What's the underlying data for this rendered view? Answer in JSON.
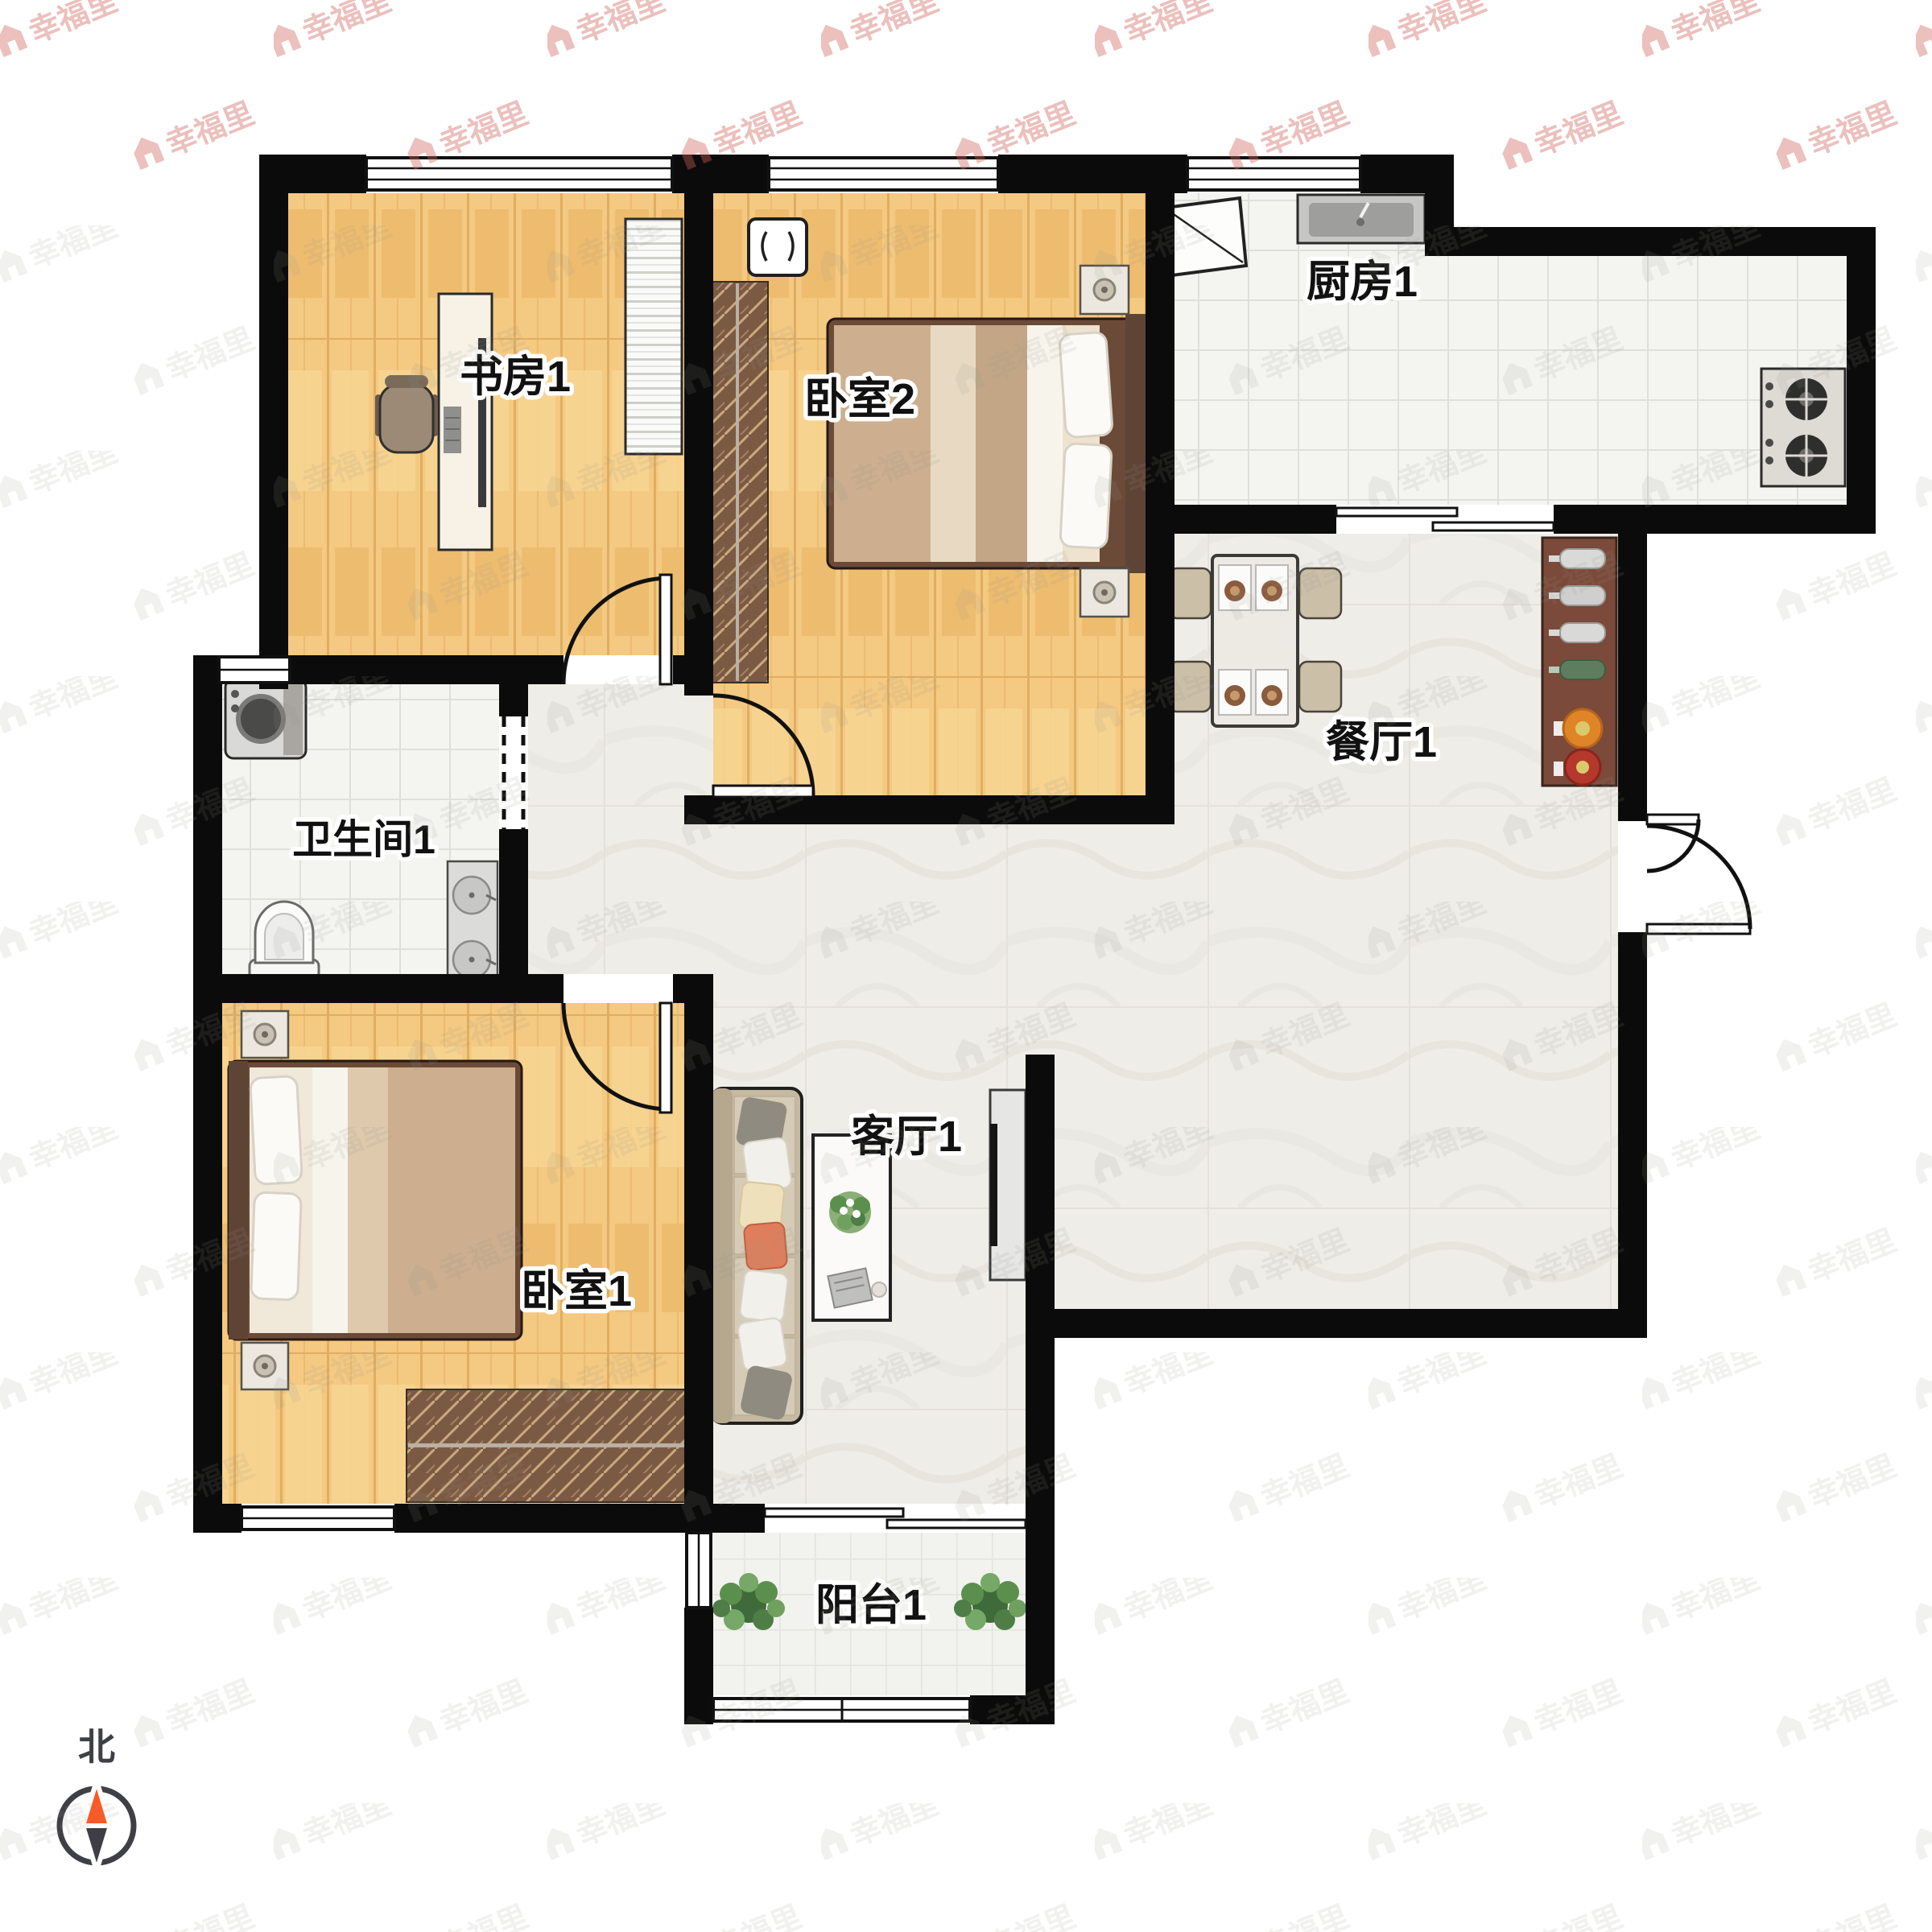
{
  "meta": {
    "type": "apartment-floorplan"
  },
  "watermark": {
    "brand": "幸福里"
  },
  "compass": {
    "north_label": "北"
  },
  "rooms": [
    {
      "id": "study",
      "label": "书房1"
    },
    {
      "id": "bedroom-2",
      "label": "卧室2"
    },
    {
      "id": "kitchen",
      "label": "厨房1"
    },
    {
      "id": "dining",
      "label": "餐厅1"
    },
    {
      "id": "bathroom",
      "label": "卫生间1"
    },
    {
      "id": "bedroom-1",
      "label": "卧室1"
    },
    {
      "id": "living",
      "label": "客厅1"
    },
    {
      "id": "balcony",
      "label": "阳台1"
    }
  ],
  "colors": {
    "wall": "#0B0B0B",
    "wood_floor": "#F4C981",
    "tile_floor": "#F3F3EF",
    "marble_floor": "#EFEDE8",
    "wardrobe": "#7B5A44",
    "compass_north": "#FF5722",
    "compass_south": "#3E3E44",
    "watermark_gray": "#8F8D86",
    "watermark_red": "#DD4F44"
  }
}
